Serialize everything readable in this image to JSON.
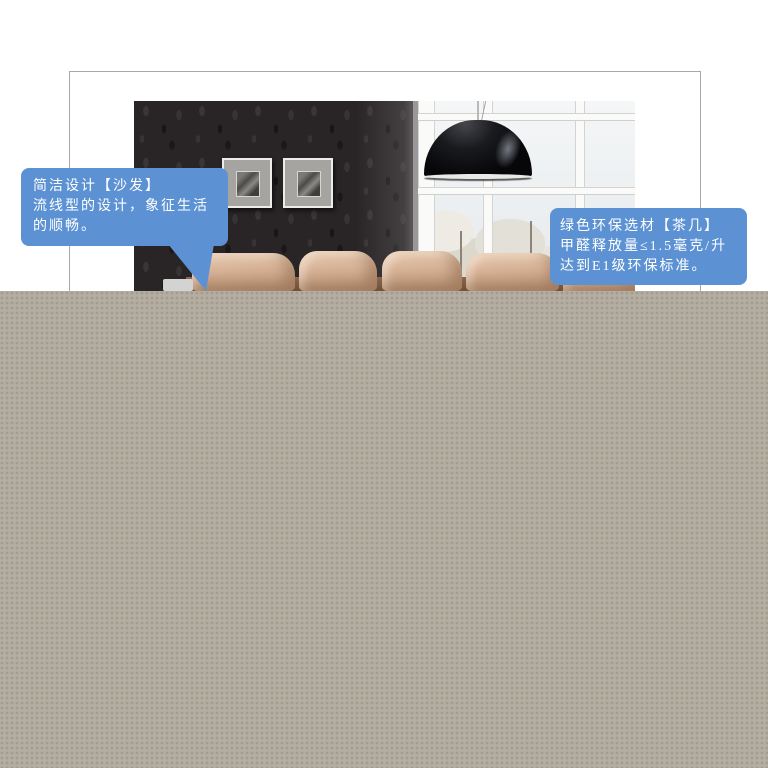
{
  "product_banner": {
    "callout_left": {
      "lines": [
        "简洁设计【沙发】",
        "流线型的设计，象征生活",
        "的顺畅。"
      ]
    },
    "callout_right": {
      "lines": [
        "绿色环保选材【茶几】",
        "甲醛释放量≤1.5毫克/升",
        "达到E1级环保标准。"
      ]
    }
  },
  "colors": {
    "page_background": "#ffffff",
    "frame_border": "#a9a9a9",
    "callout_blue": "#5c92d4",
    "callout_text": "#ffffff",
    "overlay_gray": "#b4ada1",
    "overlay_dot": "#a39c8f",
    "wall_dark": "#292526",
    "sofa_tan": "#d6b296",
    "lamp_black": "#0d0d0f",
    "house_yellow": "#ecd77c"
  }
}
